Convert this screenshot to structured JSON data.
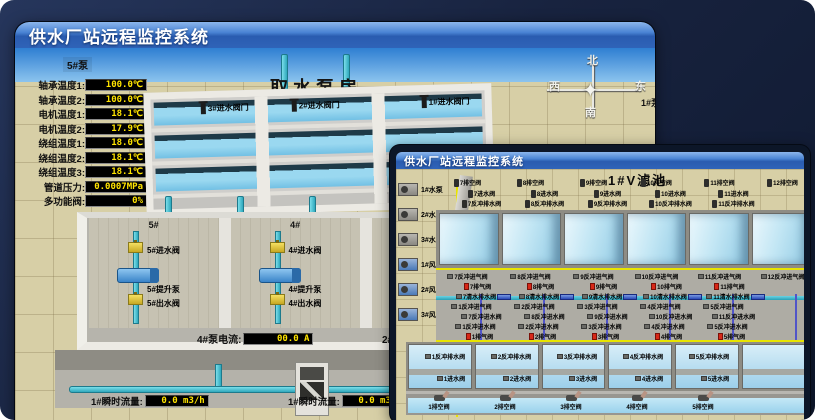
{
  "colors": {
    "titlebar_blue": "#2f63b8",
    "background_navy": "#18233f",
    "readout_text_yellow": "#ffe400",
    "pipe_cyan": "#2fa8bc",
    "valve_yellow": "#e8cf3e",
    "water_blue": "#a6d8ee",
    "alarm_red": "#d82818",
    "ground_beige": "#d7cfa6"
  },
  "back_window": {
    "title": "供水厂站远程监控系统",
    "scene_title": "取水泵房",
    "pump_panel": {
      "header": "5#泵",
      "readouts": [
        {
          "label": "轴承温度1:",
          "value": "100.0℃"
        },
        {
          "label": "轴承温度2:",
          "value": "100.0℃"
        },
        {
          "label": "电机温度1:",
          "value": "18.1℃"
        },
        {
          "label": "电机温度2:",
          "value": "17.9℃"
        },
        {
          "label": "绕组温度1:",
          "value": "18.0℃"
        },
        {
          "label": "绕组温度2:",
          "value": "18.1℃"
        },
        {
          "label": "绕组温度3:",
          "value": "18.1℃"
        },
        {
          "label": "管道压力:",
          "value": "0.0007MPa"
        },
        {
          "label": "多功能阀:",
          "value": "0%"
        }
      ]
    },
    "intake_valves": [
      "3#进水阀门",
      "2#进水阀门",
      "1#进水阀门"
    ],
    "compass": {
      "north": "北",
      "west": "西",
      "south": "南",
      "east": "东"
    },
    "right_panel": {
      "header": "1#泵",
      "labels": [
        "轴承温度1:",
        "轴承温度2:"
      ]
    },
    "pump_bays": [
      {
        "id": "5#",
        "inlet": "5#进水阀",
        "pump": "5#提升泵",
        "outlet": "5#出水阀"
      },
      {
        "id": "4#",
        "inlet": "4#进水阀",
        "pump": "4#提升泵",
        "outlet": "4#出水阀"
      },
      {
        "id": "3#",
        "inlet": "3#进水阀",
        "pump": "3#提升泵",
        "outlet": "3#出水阀"
      },
      {
        "id": "2#",
        "inlet": "2#进水阀",
        "pump": "2#提升泵",
        "outlet": "2#出水阀"
      }
    ],
    "current_readouts": [
      {
        "label": "4#泵电流:",
        "value": "00.0 A"
      },
      {
        "label": "2#泵电流:",
        "value": ""
      }
    ],
    "flow_readouts": [
      {
        "label": "1#瞬时流量:",
        "value": "0.0 m3/h"
      },
      {
        "label": "1#瞬时流量:",
        "value": "0.0 m3/h"
      }
    ]
  },
  "front_window": {
    "title": "供水厂站远程监控系统",
    "scene_title": "1#V滤池",
    "equipment": [
      "1#水泵",
      "2#水泵",
      "3#水泵",
      "1#风机",
      "2#风机",
      "3#风机"
    ],
    "top_drain_valves": [
      "7排空阀",
      "8排空阀",
      "9排空阀",
      "10排空阀",
      "11排空阀",
      "12排空阀"
    ],
    "top_inlet_valves": [
      "7进水阀",
      "8进水阀",
      "9进水阀",
      "10进水阀",
      "11进水阀"
    ],
    "top_backwash_drain_valves": [
      "7反冲排水阀",
      "8反冲排水阀",
      "9反冲排水阀",
      "10反冲排水阀",
      "11反冲排水阀"
    ],
    "mid_valves": {
      "backwash_air_upper": [
        "7反冲进气阀",
        "8反冲进气阀",
        "9反冲进气阀",
        "10反冲进气阀",
        "11反冲进气阀",
        "12反冲进气阀"
      ],
      "exhaust_upper": [
        "7排气阀",
        "8排气阀",
        "9排气阀",
        "10排气阀",
        "11排气阀"
      ],
      "clean_drain_upper": [
        "7清水排水阀",
        "8清水排水阀",
        "9清水排水阀",
        "10清水排水阀",
        "11清水排水阀"
      ],
      "backwash_air_lower": [
        "1反冲进气阀",
        "2反冲进气阀",
        "3反冲进气阀",
        "4反冲进气阀",
        "5反冲进气阀"
      ],
      "backwash_water_upper": [
        "7反冲进水阀",
        "8反冲进水阀",
        "9反冲进水阀",
        "10反冲进水阀",
        "11反冲进水阀"
      ],
      "backwash_water_lower": [
        "1反冲进水阀",
        "2反冲进水阀",
        "3反冲进水阀",
        "4反冲进水阀",
        "5反冲进水阀"
      ],
      "exhaust_lower": [
        "1排气阀",
        "2排气阀",
        "3排气阀",
        "4排气阀",
        "5排气阀"
      ]
    },
    "bottom_cells": {
      "backwash_drain_valves": [
        "1反冲排水阀",
        "2反冲排水阀",
        "3反冲排水阀",
        "4反冲排水阀",
        "5反冲排水阀"
      ],
      "inlet_valves": [
        "1进水阀",
        "2进水阀",
        "3进水阀",
        "4进水阀",
        "5进水阀"
      ],
      "drain_valves": [
        "1排空阀",
        "2排空阀",
        "3排空阀",
        "4排空阀",
        "5排空阀"
      ]
    }
  }
}
